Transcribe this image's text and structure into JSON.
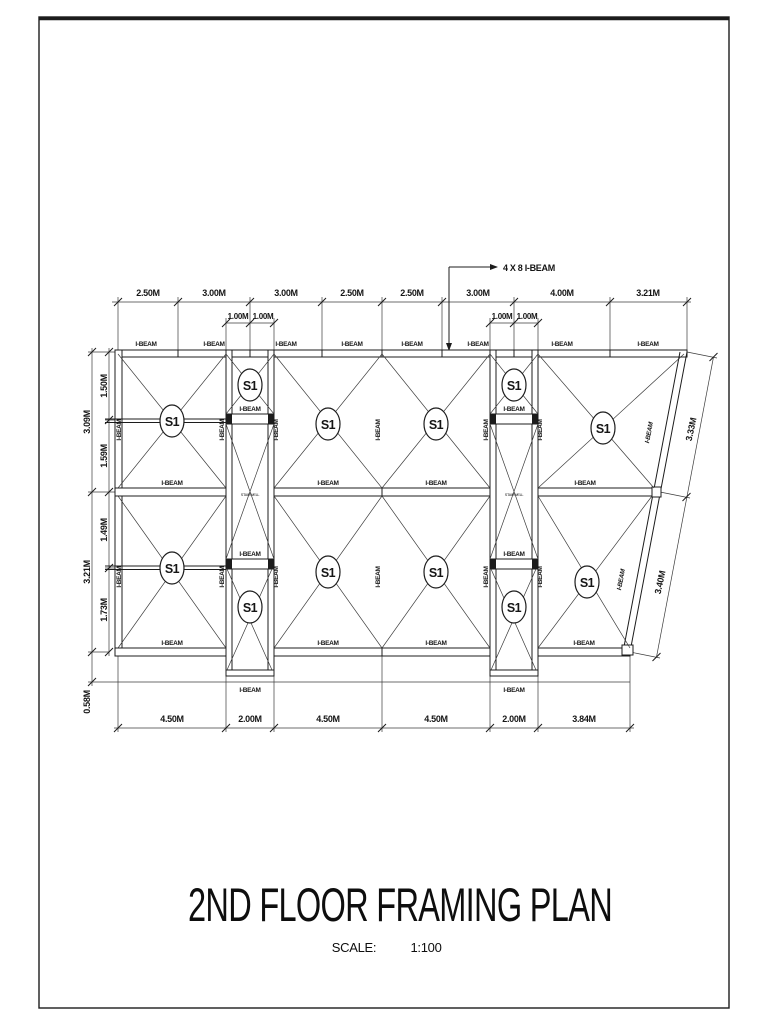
{
  "title": {
    "text": "2ND FLOOR FRAMING PLAN",
    "scale_label": "SCALE:",
    "scale_value": "1:100"
  },
  "callout": {
    "text": "4 X 8 I-BEAM"
  },
  "labels": {
    "i_beam": "I-BEAM",
    "stairwell": "STAIRWELL",
    "s1": "S1"
  },
  "dimensions": {
    "top": [
      "2.50M",
      "3.00M",
      "3.00M",
      "2.50M",
      "2.50M",
      "3.00M",
      "4.00M",
      "3.21M"
    ],
    "top_sub_left": [
      "1.00M",
      "1.00M"
    ],
    "top_sub_right": [
      "1.00M",
      "1.00M"
    ],
    "left_outer": [
      "3.09M",
      "3.21M",
      "0.58M"
    ],
    "left_inner": [
      "1.50M",
      "1.59M",
      "1.49M",
      "1.73M"
    ],
    "bottom": [
      "4.50M",
      "2.00M",
      "4.50M",
      "4.50M",
      "2.00M",
      "3.84M"
    ],
    "right_slant": [
      "3.33M",
      "3.40M"
    ]
  }
}
